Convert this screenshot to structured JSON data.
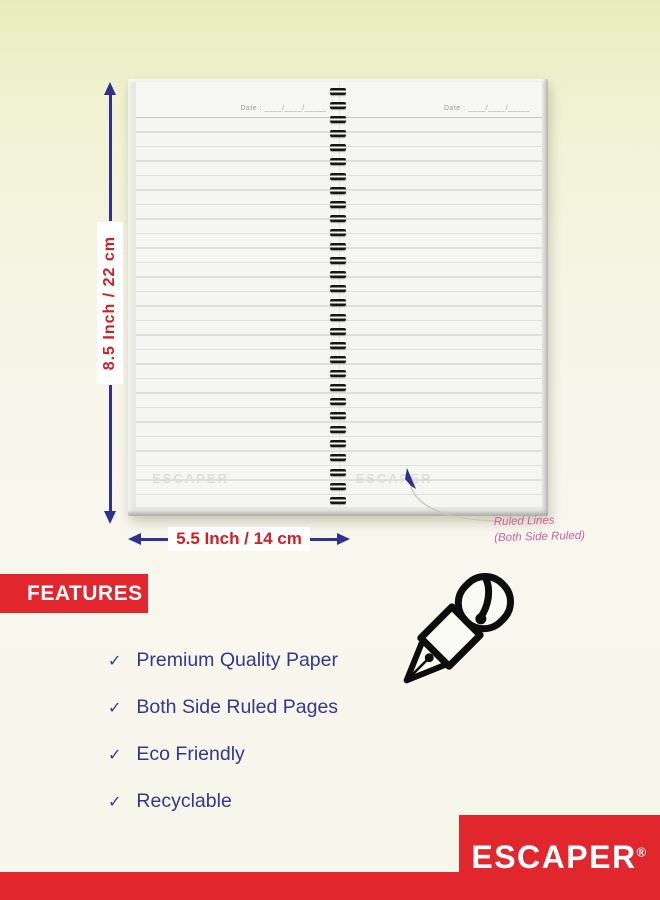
{
  "notebook": {
    "date_label": "Date : ____/____/_____",
    "watermark": "ESCAPER"
  },
  "dimensions": {
    "height_label": "8.5 Inch / 22 cm",
    "width_label": "5.5 Inch / 14 cm"
  },
  "annotation": {
    "line1": "Ruled Lines",
    "line2": "(Both Side Ruled)"
  },
  "features": {
    "heading": "FEATURES",
    "check_glyph": "✓",
    "items": [
      "Premium Quality Paper",
      "Both Side Ruled Pages",
      "Eco Friendly",
      "Recyclable"
    ]
  },
  "brand": {
    "name": "ESCAPER",
    "registered_mark": "®"
  },
  "colors": {
    "background_top": "#e9edbc",
    "background_cream": "#f8f7ee",
    "red": "#e2262d",
    "dimension_text_red": "#cc2127",
    "dimension_arrow_blue": "#2e3192",
    "feature_text_blue": "#34378b",
    "annotation_pink": "#cf5f9f"
  }
}
